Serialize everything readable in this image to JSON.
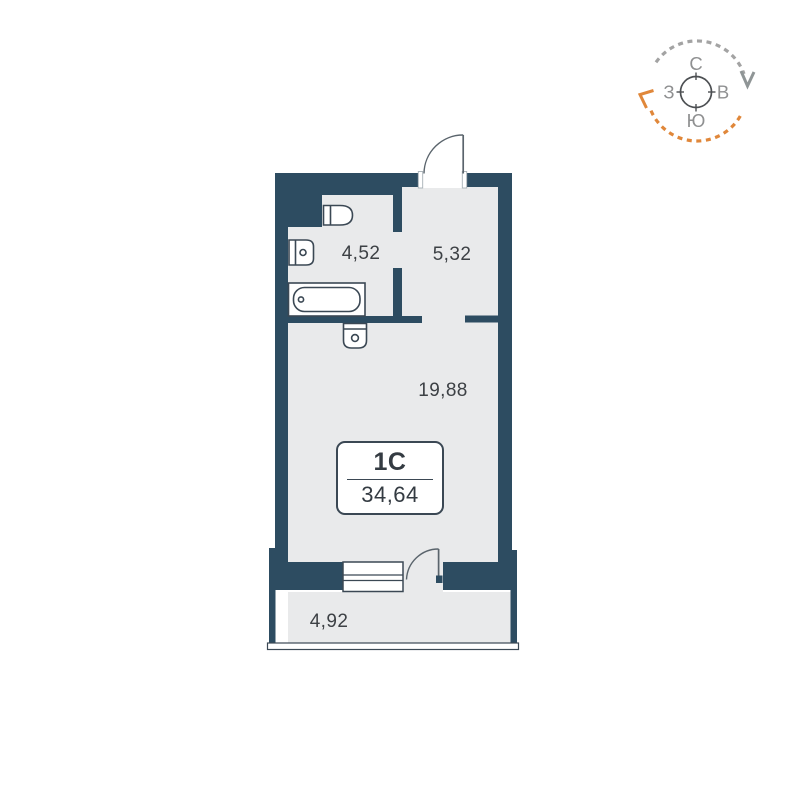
{
  "plan": {
    "unit": {
      "type_label": "1С",
      "area_total": "34,64"
    },
    "rooms": [
      {
        "id": "bathroom",
        "area": "4,52"
      },
      {
        "id": "hallway",
        "area": "5,32"
      },
      {
        "id": "living-room",
        "area": "19,88"
      },
      {
        "id": "balcony",
        "area": "4,92"
      }
    ]
  },
  "compass": {
    "north": "С",
    "east": "В",
    "south": "Ю",
    "west": "З"
  },
  "colors": {
    "wall": "#2d4c61",
    "floor": "#e9eaeb",
    "fixture_line": "#3b4854",
    "door_line": "#5a646c",
    "label_text": "#3d4145",
    "compass_gray": "#a3a3a3",
    "compass_orange": "#e0873a",
    "compass_letters": "#8f9091"
  }
}
